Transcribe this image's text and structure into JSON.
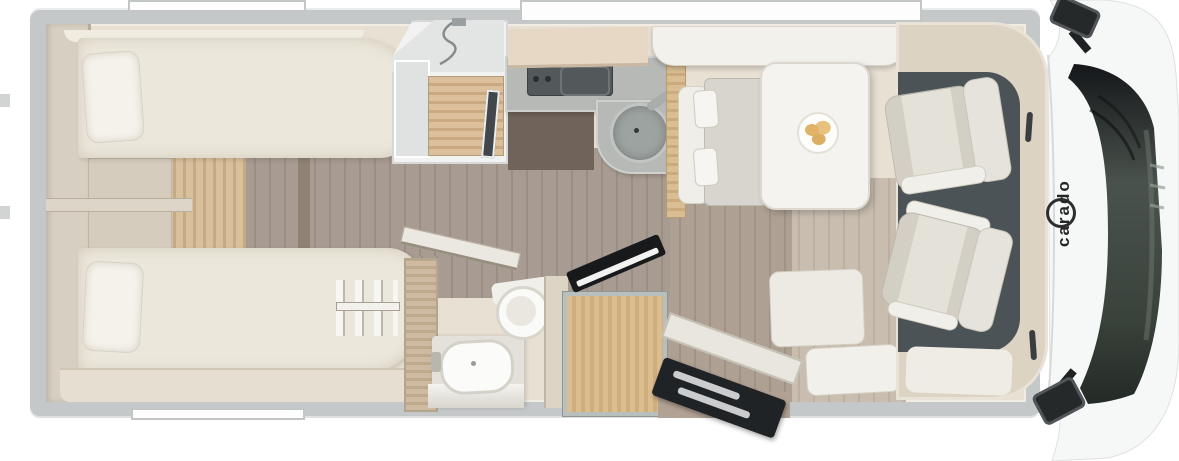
{
  "meta": {
    "type": "motorhome-floor-plan-top-view"
  },
  "brand": {
    "label": "carado"
  },
  "palette": {
    "background": "#ffffff",
    "wall": "#c5c8c9",
    "interior": "#e8e0d3",
    "furniture_light": "#ece7db",
    "wood_step": "#d2b58c",
    "wood_floor": "#a3958a",
    "counter_gray": "#b6b9b5",
    "fixture_dark": "#53585a",
    "cab_floor": "#4c5357",
    "seat_upholstery": "#dcd8ce",
    "windshield_glass": "#3c443e",
    "entry_door_dark": "#202325",
    "logo_color": "#262626"
  },
  "plan": {
    "bedroom": {
      "fixtures": [
        "wardrobe-icon",
        "single-bed-icon",
        "single-bed-icon",
        "pillow-icon",
        "step-icon",
        "ladder-icon"
      ]
    },
    "washroom": {
      "fixtures": [
        "shower-icon",
        "shower-head-icon",
        "washbasin-icon",
        "faucet-icon",
        "mirror-icon",
        "toilet-icon",
        "door-icon"
      ]
    },
    "kitchen": {
      "fixtures": [
        "hob-icon",
        "sink-icon",
        "faucet-icon",
        "overhead-cabinet-icon",
        "refrigerator-icon"
      ]
    },
    "dinette": {
      "fixtures": [
        "sideboard-icon",
        "bench-seat-icon",
        "table-icon",
        "plate-icon",
        "side-bench-icon"
      ]
    },
    "cab": {
      "fixtures": [
        "driver-seat-icon",
        "passenger-seat-icon",
        "dashboard-icon",
        "windshield-icon",
        "side-mirror-icon",
        "side-mirror-icon",
        "entry-door-icon",
        "entry-step-icon"
      ]
    }
  }
}
